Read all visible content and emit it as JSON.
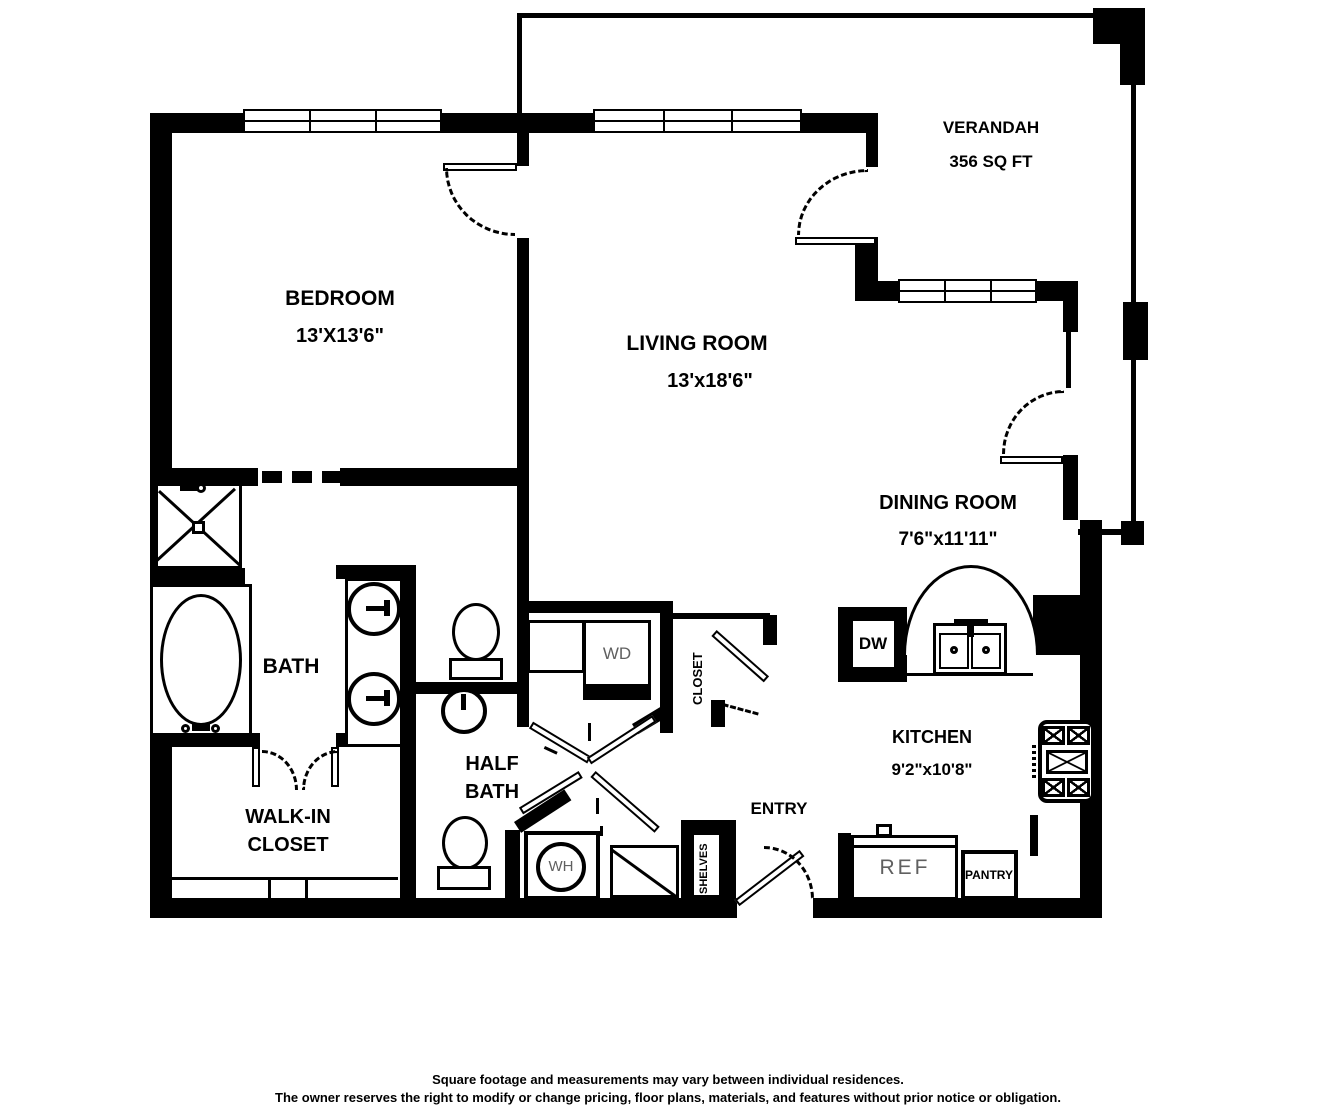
{
  "rooms": {
    "verandah": {
      "name": "VERANDAH",
      "area": "356 SQ FT"
    },
    "bedroom": {
      "name": "BEDROOM",
      "dims": "13'X13'6\""
    },
    "living": {
      "name": "LIVING ROOM",
      "dims": "13'x18'6\""
    },
    "dining": {
      "name": "DINING ROOM",
      "dims": "7'6\"x11'11\""
    },
    "kitchen": {
      "name": "KITCHEN",
      "dims": "9'2\"x10'8\""
    },
    "bath": {
      "name": "BATH"
    },
    "half_bath": {
      "line1": "HALF",
      "line2": "BATH"
    },
    "walk_in_closet": {
      "line1": "WALK-IN",
      "line2": "CLOSET"
    },
    "entry": {
      "name": "ENTRY"
    }
  },
  "fixtures": {
    "washer_dryer": "WD",
    "dishwasher": "DW",
    "water_heater": "WH",
    "refrigerator": "REF",
    "pantry": "PANTRY",
    "closet": "CLOSET",
    "shelves": "SHELVES"
  },
  "disclaimer": {
    "line1": "Square footage and measurements may vary between individual residences.",
    "line2": "The owner reserves the right to modify or change pricing, floor plans, materials, and features without prior notice or obligation."
  },
  "colors": {
    "wall": "#000000",
    "background": "#ffffff",
    "light_text": "#606060"
  }
}
